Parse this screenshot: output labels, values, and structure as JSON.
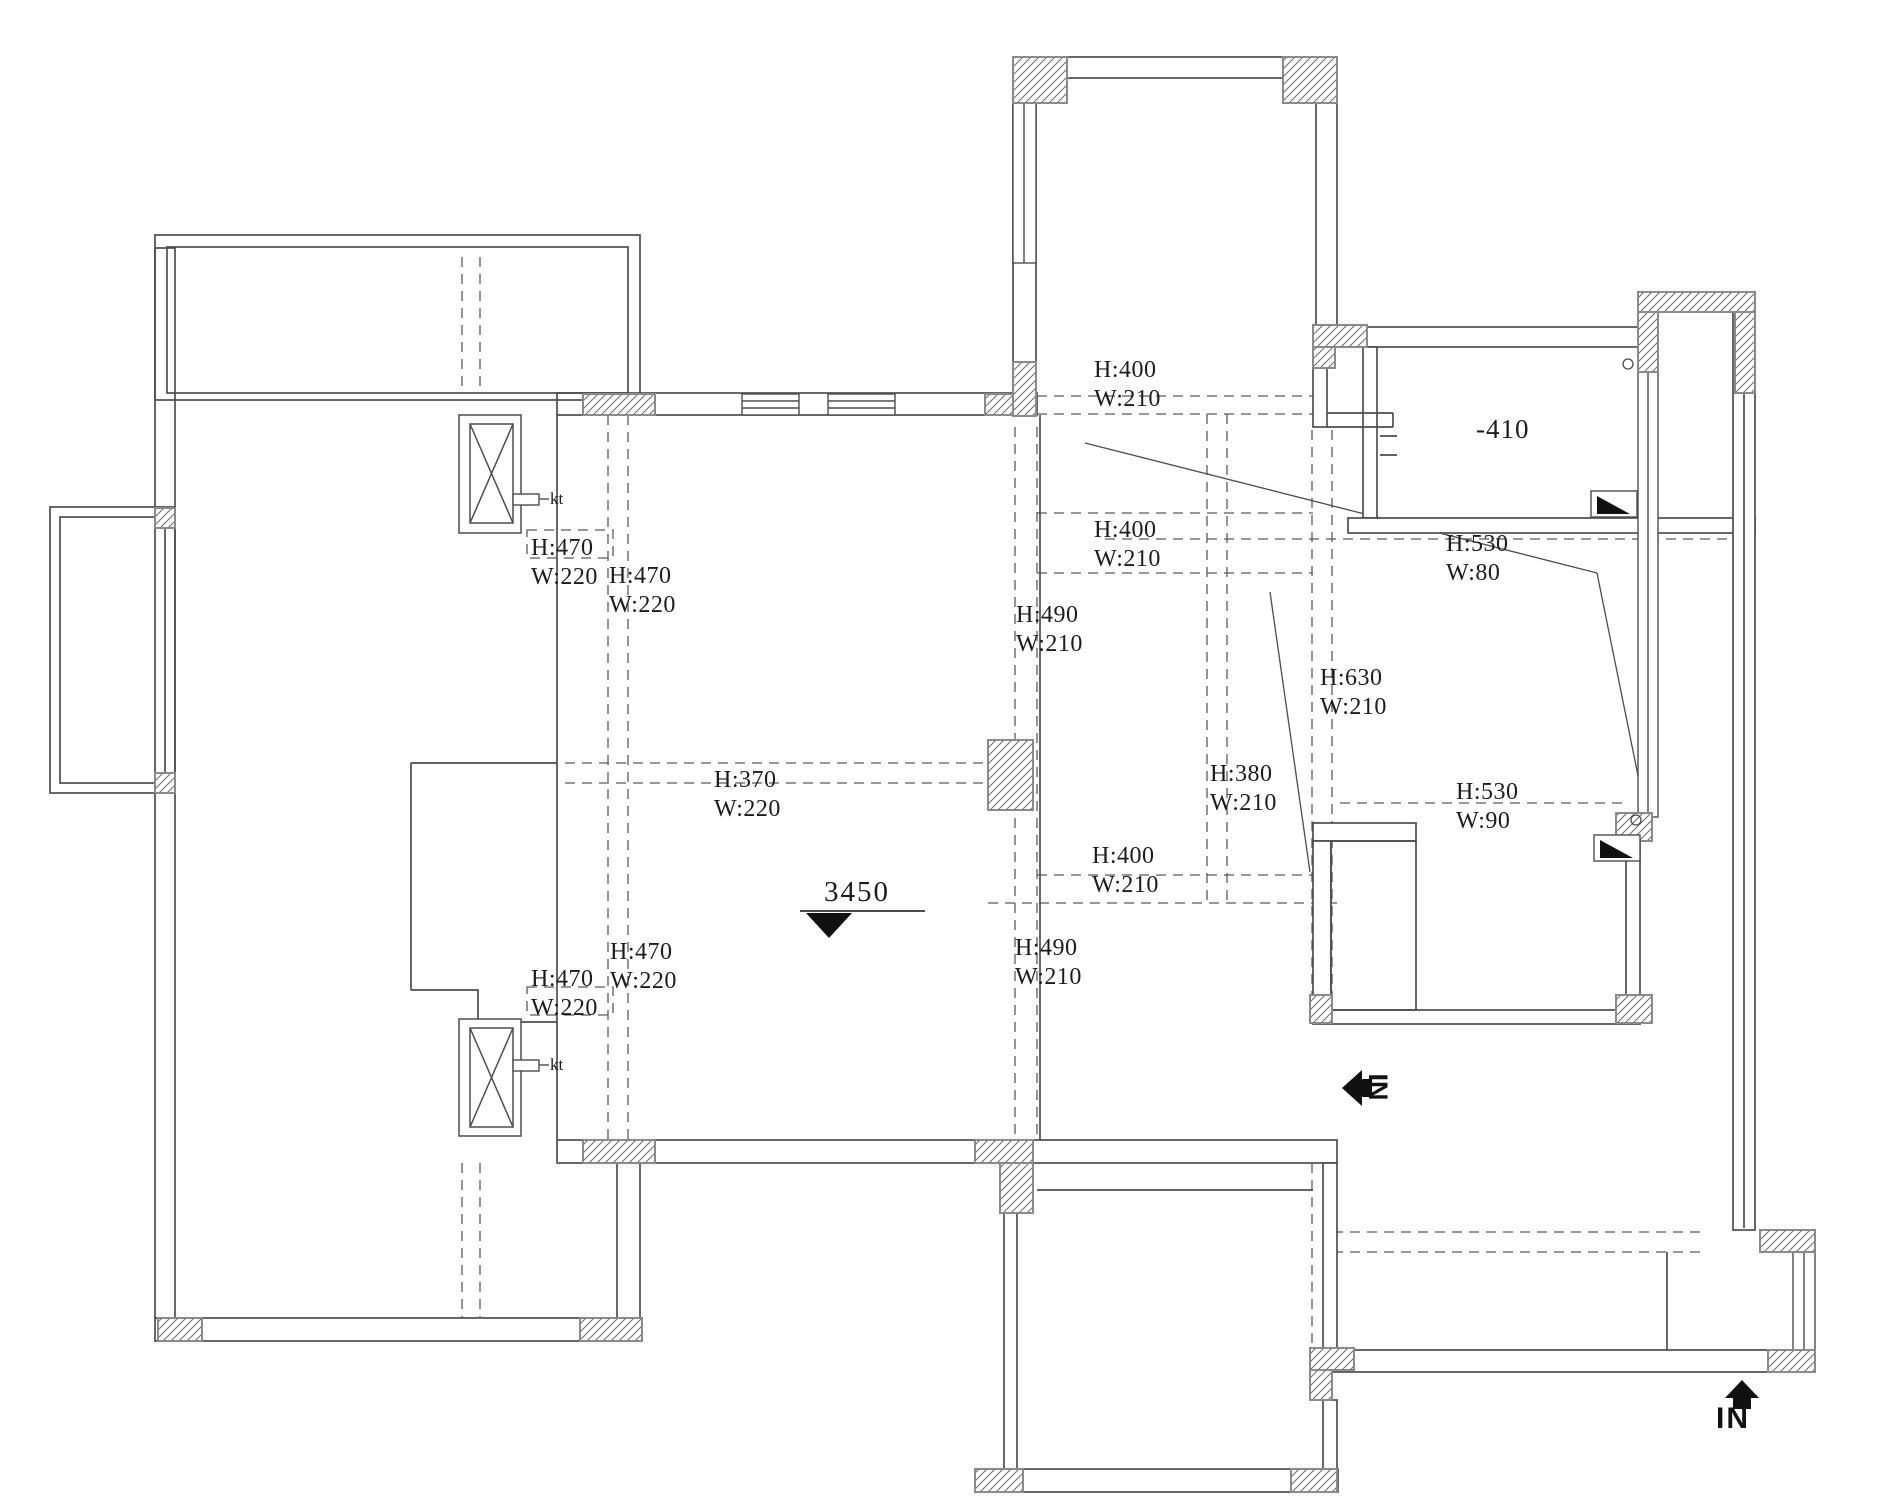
{
  "drawing": {
    "title": "apartment-floor-plan",
    "elevation_marker": "3450",
    "floor_level_label": "-410",
    "ac_outlet_labels": [
      "kt",
      "kt"
    ],
    "entry_markers": [
      {
        "id": "side-entry",
        "label": "IN",
        "direction": "left"
      },
      {
        "id": "bottom-entry",
        "label": "IN",
        "direction": "up"
      }
    ],
    "dimension_labels": [
      {
        "id": "kitchen-top",
        "h": "H:400",
        "w": "W:210"
      },
      {
        "id": "kitchen-upper",
        "h": "H:400",
        "w": "W:210"
      },
      {
        "id": "dining-upper",
        "h": "H:490",
        "w": "W:210"
      },
      {
        "id": "hall-right",
        "h": "H:530",
        "w": "W:80"
      },
      {
        "id": "bedroom-right",
        "h": "H:630",
        "w": "W:210"
      },
      {
        "id": "dining-right",
        "h": "H:380",
        "w": "W:210"
      },
      {
        "id": "bath-right",
        "h": "H:530",
        "w": "W:90"
      },
      {
        "id": "dining-mid",
        "h": "H:400",
        "w": "W:210"
      },
      {
        "id": "dining-lower",
        "h": "H:490",
        "w": "W:210"
      },
      {
        "id": "living-left-upper-outer",
        "h": "H:470",
        "w": "W:220"
      },
      {
        "id": "living-left-upper-inner",
        "h": "H:470",
        "w": "W:220"
      },
      {
        "id": "living-center",
        "h": "H:370",
        "w": "W:220"
      },
      {
        "id": "living-left-lower-inner",
        "h": "H:470",
        "w": "W:220"
      },
      {
        "id": "living-left-lower-outer",
        "h": "H:470",
        "w": "W:220"
      }
    ]
  },
  "colors": {
    "background": "#ffffff",
    "wall_line": "#4d4d4d",
    "dash_line": "#5a5a5a",
    "hatch_line": "#6f6f6f",
    "column_border": "#8a8a8a",
    "text": "#1c1c1c",
    "solid_black": "#111111"
  }
}
